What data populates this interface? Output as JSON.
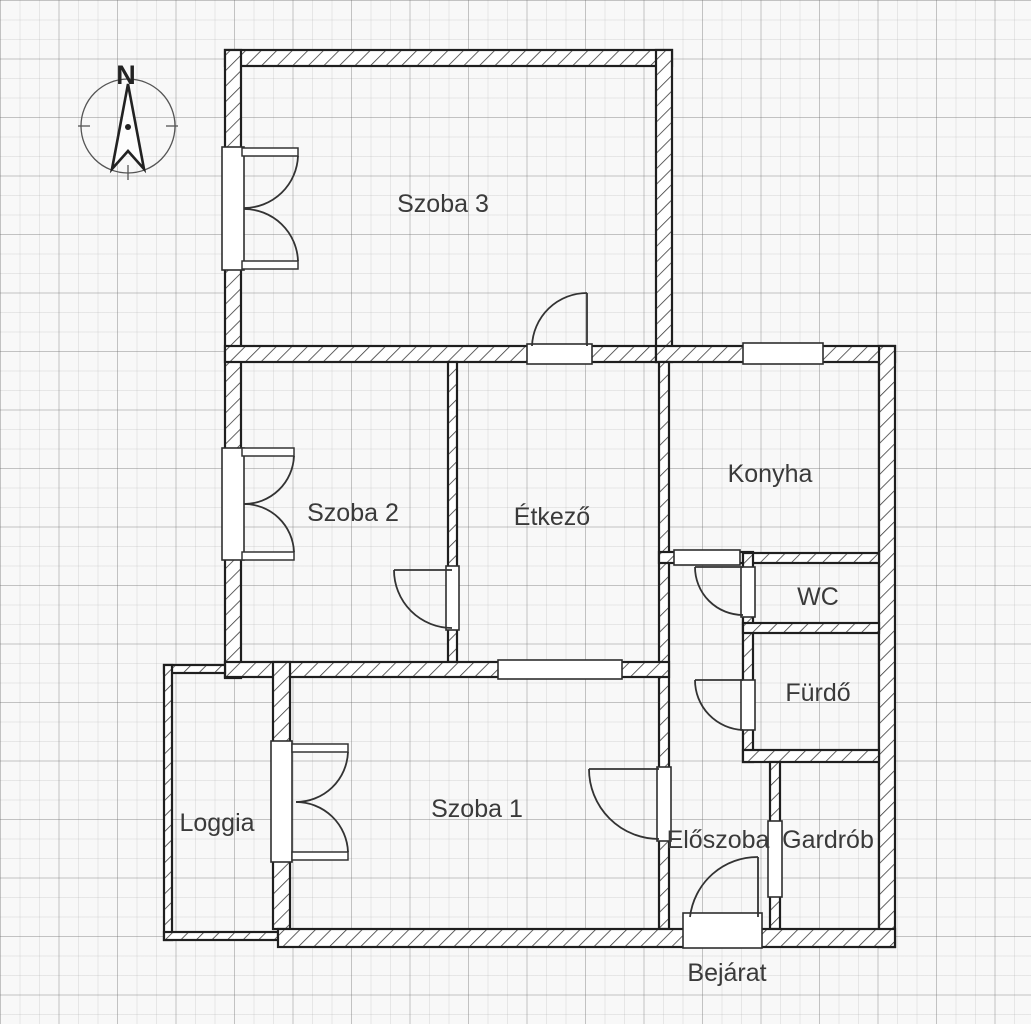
{
  "compass": {
    "north_label": "N"
  },
  "rooms": [
    {
      "id": "szoba-3",
      "label": "Szoba 3"
    },
    {
      "id": "szoba-2",
      "label": "Szoba 2"
    },
    {
      "id": "etkezo",
      "label": "Étkező"
    },
    {
      "id": "konyha",
      "label": "Konyha"
    },
    {
      "id": "wc",
      "label": "WC"
    },
    {
      "id": "furdo",
      "label": "Fürdő"
    },
    {
      "id": "loggia",
      "label": "Loggia"
    },
    {
      "id": "szoba-1",
      "label": "Szoba 1"
    },
    {
      "id": "eloszoba",
      "label": "Előszoba"
    },
    {
      "id": "gardrob",
      "label": "Gardrób"
    }
  ],
  "entrance": {
    "label": "Bejárat"
  },
  "colors": {
    "background": "#f8f8f8",
    "grid_minor": "#dddddd",
    "grid_major": "#bdbdbd",
    "wall_outline": "#1f1f1f",
    "wall_hatch": "#3a3a3a",
    "opening_fill": "#ffffff",
    "label_text": "#3a3a3a"
  }
}
